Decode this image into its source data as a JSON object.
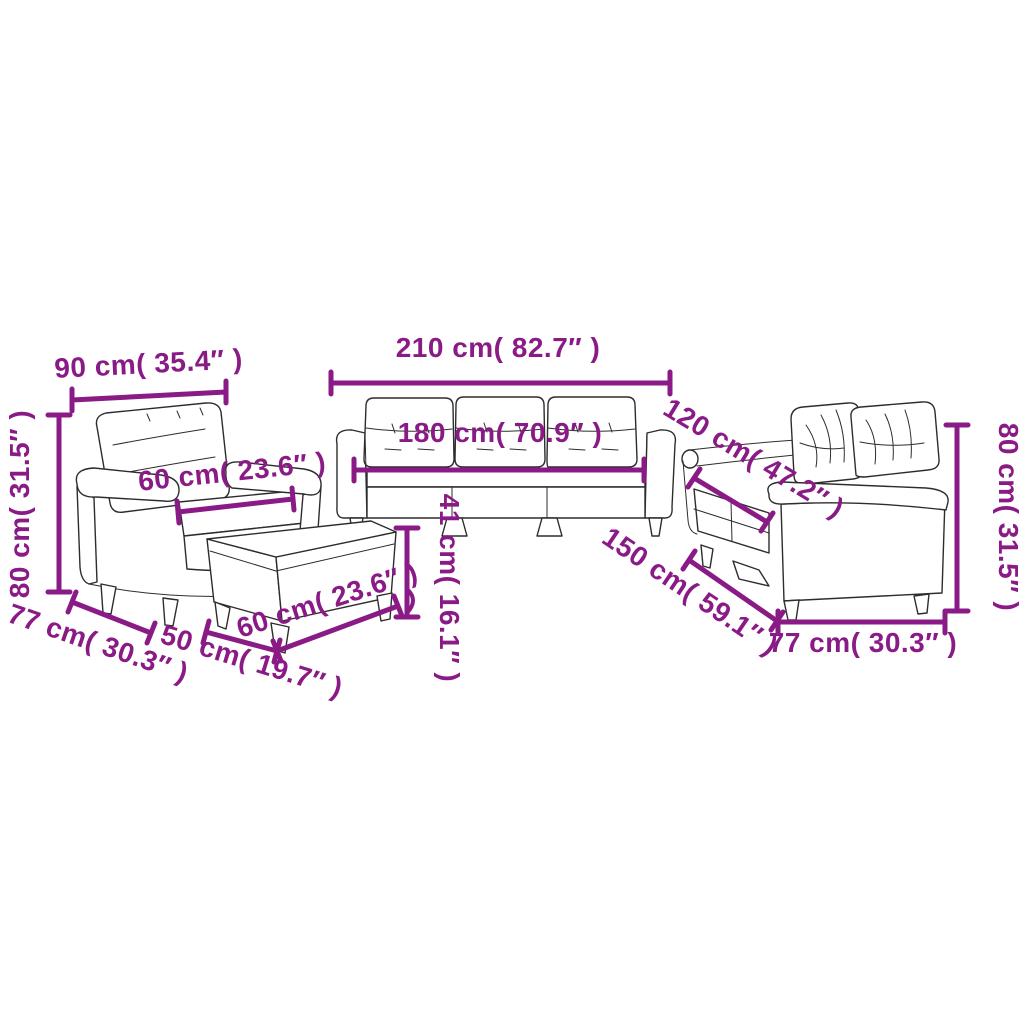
{
  "diagram": {
    "type": "furniture-dimension-line-drawing",
    "subject": "4-piece sofa set: armchair, 3-seater sofa, 2-seater sofa, footstool",
    "background_color": "#ffffff",
    "drawing_line_color": "#2d2d2d",
    "dimension_color": "#8a1b86",
    "pieces": [
      "armchair",
      "three-seater-sofa",
      "two-seater-sofa",
      "footstool"
    ]
  },
  "dimensions": [
    {
      "piece": "armchair",
      "measure": "width",
      "label": "90 cm( 35.4″ )"
    },
    {
      "piece": "armchair",
      "measure": "height",
      "label": "80 cm( 31.5″ )"
    },
    {
      "piece": "armchair",
      "measure": "depth",
      "label": "77 cm( 30.3″ )"
    },
    {
      "piece": "armchair",
      "measure": "seat-width",
      "label": "60 cm( 23.6″ )"
    },
    {
      "piece": "three-seater-sofa",
      "measure": "width",
      "label": "210 cm( 82.7″ )"
    },
    {
      "piece": "three-seater-sofa",
      "measure": "seat-width",
      "label": "180 cm( 70.9″ )"
    },
    {
      "piece": "footstool",
      "measure": "height",
      "label": "41 cm( 16.1″ )"
    },
    {
      "piece": "footstool",
      "measure": "width",
      "label": "60 cm( 23.6″ )"
    },
    {
      "piece": "footstool",
      "measure": "depth",
      "label": "50 cm( 19.7″ )"
    },
    {
      "piece": "two-seater-sofa",
      "measure": "seat-width",
      "label": "120 cm( 47.2″ )"
    },
    {
      "piece": "two-seater-sofa",
      "measure": "width",
      "label": "150 cm( 59.1″ )"
    },
    {
      "piece": "two-seater-sofa",
      "measure": "height",
      "label": "80 cm( 31.5″ )"
    },
    {
      "piece": "two-seater-sofa",
      "measure": "depth",
      "label": "77 cm( 30.3″ )"
    }
  ]
}
